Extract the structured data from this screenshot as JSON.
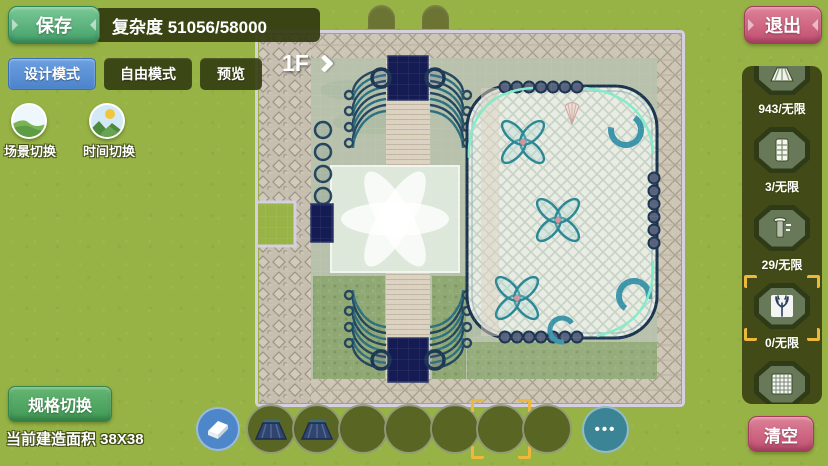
{
  "topbar": {
    "save": "保存",
    "complexity": "复杂度 51056/58000",
    "exit": "退出",
    "modes": {
      "design": "设计模式",
      "free": "自由模式",
      "preview": "预览"
    },
    "scene_switch": "场景切换",
    "time_switch": "时间切换"
  },
  "map": {
    "floor": "1F"
  },
  "sidebar": {
    "slots": [
      {
        "name": "awning",
        "count": "943/无限"
      },
      {
        "name": "door",
        "count": "3/无限"
      },
      {
        "name": "pillar",
        "count": "29/无限"
      },
      {
        "name": "antler",
        "count": "0/无限",
        "selected": true
      },
      {
        "name": "lattice",
        "count": ""
      }
    ],
    "clear": "清空"
  },
  "bottombar": {
    "spec_switch": "规格切换",
    "build_area": "当前建造面积 38X38",
    "more": "•••",
    "slots": [
      {
        "item": "roof-awning",
        "selected": false
      },
      {
        "item": "roof-awning",
        "selected": false
      },
      {
        "item": "",
        "selected": false
      },
      {
        "item": "",
        "selected": false
      },
      {
        "item": "",
        "selected": false
      },
      {
        "item": "",
        "selected": true
      },
      {
        "item": "",
        "selected": false
      }
    ]
  },
  "colors": {
    "accent_green": "#4fae66",
    "accent_pink": "#c24e71",
    "accent_blue": "#4c83cb",
    "select_yellow": "#ecb93d",
    "grass": "#97b245"
  }
}
